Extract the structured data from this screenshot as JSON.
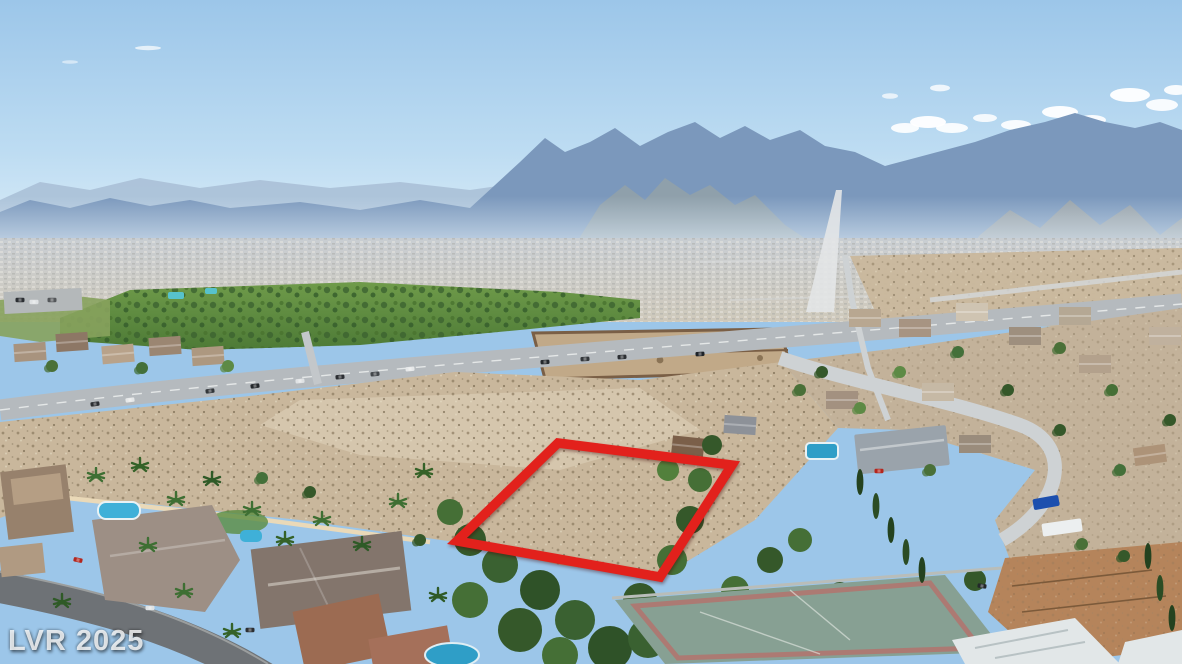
{
  "photo": {
    "watermark": "LVR 2025",
    "property_outline": {
      "points": "558,443 732,465 660,577 457,541",
      "color": "#e2211c"
    }
  },
  "palette": {
    "sky_top": "#9cc6e9",
    "sky_mid": "#bddcf2",
    "sky_horizon": "#ddeef8",
    "mtn_far": "#aac0d7",
    "mtn_mid": "#7b98bc",
    "mtn_foot": "#8fa0ab",
    "valley_a": "#c9ced3",
    "valley_b": "#cfc9bb",
    "park_a": "#6f9b4a",
    "park_b": "#4d7a36",
    "tree_dark": "#3a6131",
    "desert": "#c9b79c",
    "desert_light": "#d8cab2",
    "road": "#b5babe",
    "road_light": "#ced2d4",
    "street_dark": "#6e7276",
    "wall_cream": "#ead9b8",
    "compound_wall": "#7a5f46",
    "compound_fill": "#c1a988",
    "dirt": "#b5845b",
    "pool": "#2f9ec7",
    "white_roof": "#e2e7e8",
    "red": "#e2211c"
  }
}
